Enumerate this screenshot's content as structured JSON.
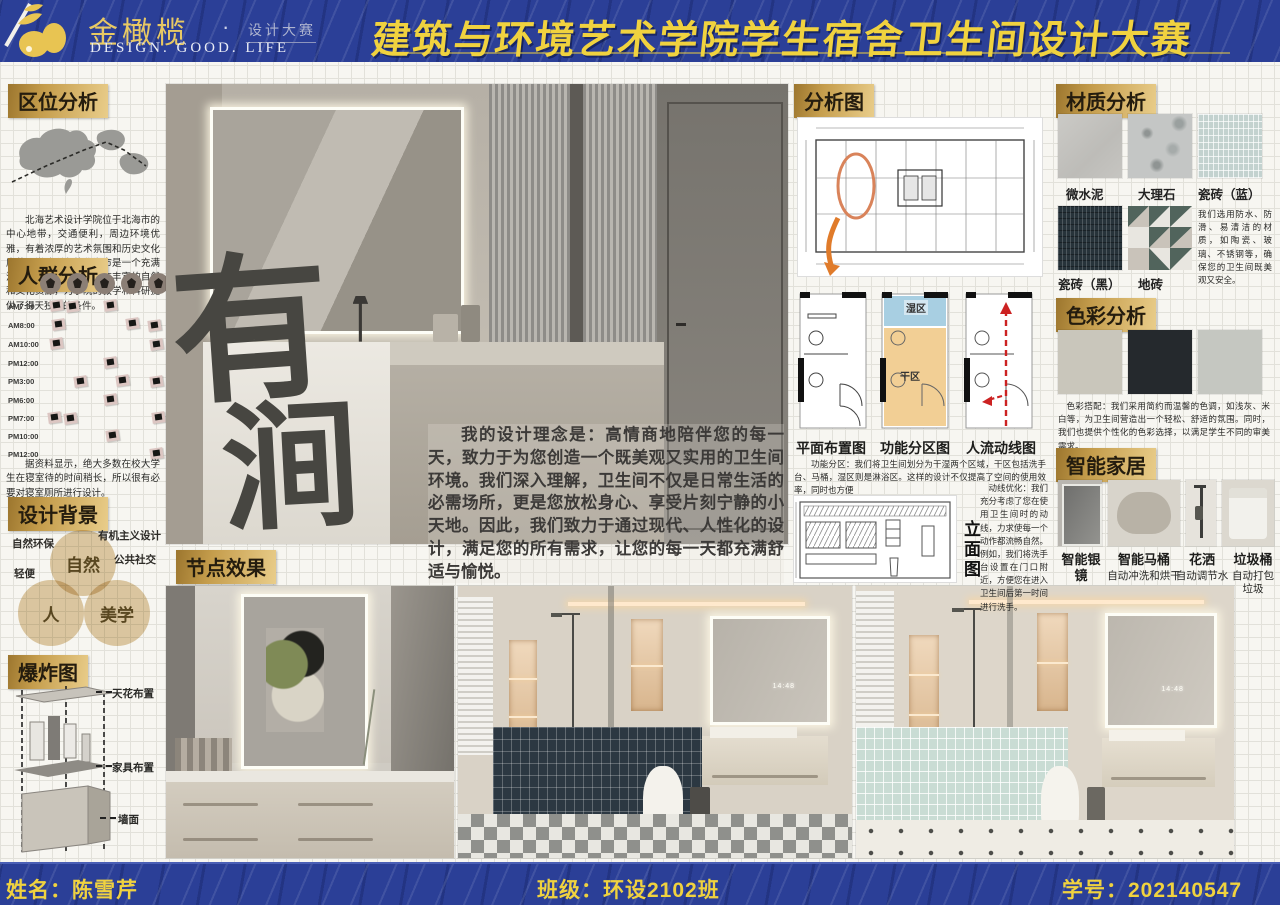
{
  "header": {
    "brand": {
      "name": "金橄榄",
      "dot": "·",
      "sub": "设计大赛",
      "tagline": "DESIGN.  GOOD.  LIFE"
    },
    "title": "建筑与环境艺术学院学生宿舍卫生间设计大赛"
  },
  "left": {
    "location": {
      "title": "区位分析",
      "body": "北海艺术设计学院位于北海市的中心地带，交通便利，周边环境优雅，有着浓厚的艺术氛围和历史文化底蕴。学院所在的北海市是一个充满活力和创新的城市，拥有丰富的自然和文化资源，为学院的教学和科研提供了得天独厚的条件。"
    },
    "crowd": {
      "title": "人群分析",
      "times": [
        "AM7:00",
        "AM8:00",
        "AM10:00",
        "PM12:00",
        "PM3:00",
        "PM6:00",
        "PM7:00",
        "PM10:00",
        "PM12:00"
      ],
      "note": "据资料显示，绝大多数在校大学生在寝室待的时间稍长，所以很有必要对寝室厕所进行设计。"
    },
    "background": {
      "title": "设计背景",
      "tag_1": "自然环保",
      "tag_2": "有机主义设计",
      "tag_3": "轻便",
      "tag_4": "公共社交",
      "venn_1": "自然",
      "venn_2": "人",
      "venn_3": "美学"
    },
    "exploded": {
      "title": "爆炸图",
      "label_1": "天花布置",
      "label_2": "家具布置",
      "label_3": "墙面"
    }
  },
  "center": {
    "calligraphy_1": "有",
    "calligraphy_2": "涧",
    "philosophy": "我的设计理念是：高情商地陪伴您的每一天，致力于为您创造一个既美观又实用的卫生间环境。我们深入理解，卫生间不仅是日常生活的必需场所，更是您放松身心、享受片刻宁静的小天地。因此，我们致力于通过现代、人性化的设计，满足您的所有需求，让您的每一天都充满舒适与愉悦。",
    "node_label": "节点效果",
    "mirror_time": "14:48"
  },
  "right": {
    "analysis": {
      "title": "分析图",
      "plan_1": "平面布置图",
      "plan_2": "功能分区图",
      "plan_3": "人流动线图",
      "wet": "湿区",
      "dry": "干区",
      "zoning": "功能分区：我们将卫生间划分为干湿两个区域，干区包括洗手台、马桶，湿区则是淋浴区。这样的设计不仅提高了空间的使用效率，同时也方便",
      "elevation": "立面图",
      "circulation": "动线优化：我们充分考虑了您在使用卫生间时的动线，力求使每一个动作都流畅自然。例如，我们将洗手台设置在门口附近，方便您在进入卫生间后第一时间进行洗手。"
    },
    "materials": {
      "title": "材质分析",
      "item_1": "微水泥",
      "item_2": "大理石",
      "item_3": "瓷砖（蓝）",
      "item_4": "瓷砖（黑）",
      "item_5": "地砖",
      "note": "我们选用防水、防滑、易清洁的材质，如陶瓷、玻璃、不锈钢等，确保您的卫生间既美观又安全。"
    },
    "palette": {
      "title": "色彩分析",
      "swatch_1": "#c9c6bb",
      "swatch_2": "#25292d",
      "swatch_3": "#c5c7c1",
      "note": "色彩搭配：我们采用简约而温馨的色调，如浅灰、米白等，为卫生间营造出一个轻松、舒适的氛围。同时，我们也提供个性化的色彩选择，以满足学生不同的审美需求。"
    },
    "smart": {
      "title": "智能家居",
      "item_1_name": "智能银镜",
      "item_2_name": "智能马桶",
      "item_2_desc": "自动冲洗和烘干",
      "item_3_name": "花洒",
      "item_3_desc": "自动调节水",
      "item_4_name": "垃圾桶",
      "item_4_desc": "自动打包垃圾"
    }
  },
  "footer": {
    "name": "姓名：陈雪芹",
    "class": "班级：环设2102班",
    "student_id": "学号：202140547"
  }
}
